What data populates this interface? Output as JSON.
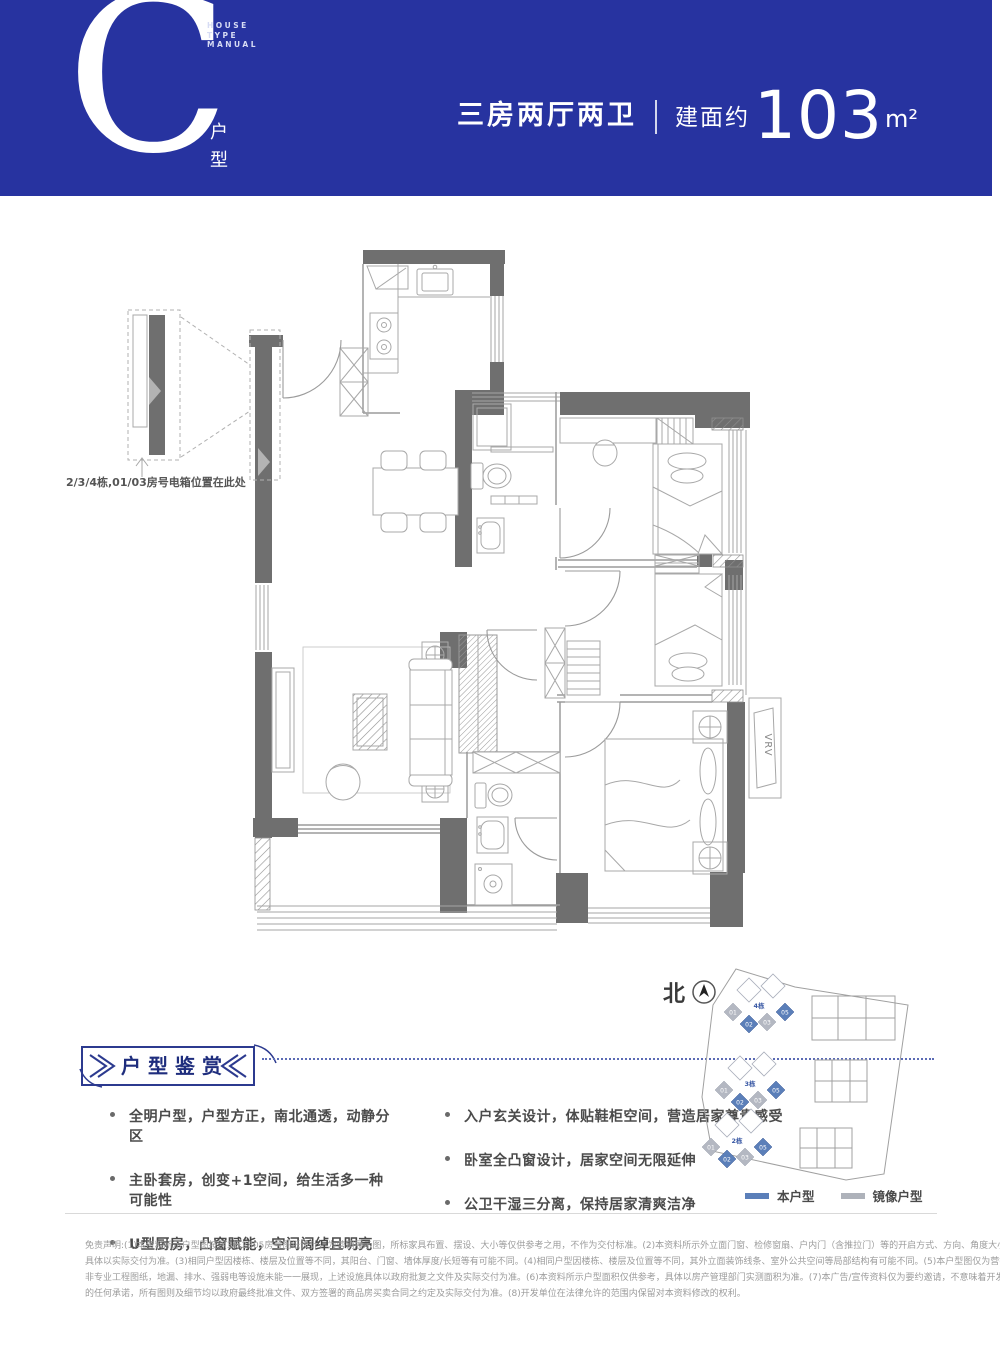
{
  "banner": {
    "letter": "C",
    "manual_text": "HOUSE\nTYPE\nMANUAL",
    "type_label": "户型",
    "spec": "三房两厅两卫",
    "area_prefix": "建面约",
    "area_number": "103",
    "area_unit": "m²",
    "bg_color": "#2733a0"
  },
  "floor_plan": {
    "callout_label": "2/3/4栋,01/03房号电箱位置在此处",
    "vrv_label": "VRV",
    "wall_color": "#6f6f6f"
  },
  "appreciation": {
    "title": "户型鉴赏",
    "left_items": [
      "全明户型，户型方正，南北通透，动静分区",
      "主卧套房，创变+1空间，给生活多一种可能性",
      "U型厨房，凸窗赋能，空间阔绰且明亮"
    ],
    "right_items": [
      "入户玄关设计，体贴鞋柜空间，营造居家尊贵感受",
      "卧室全凸窗设计，居家空间无限延伸",
      "公卫干湿三分离，保持居家清爽洁净"
    ],
    "accent_color": "#2c3a8f"
  },
  "site_plan": {
    "north_label": "北",
    "clusters": [
      {
        "name": "4栋",
        "units": [
          {
            "label": "01",
            "type": "mirror"
          },
          {
            "label": "02",
            "type": "self"
          },
          {
            "label": "03",
            "type": "mirror"
          },
          {
            "label": "05",
            "type": "self"
          }
        ]
      },
      {
        "name": "3栋",
        "units": [
          {
            "label": "01",
            "type": "mirror"
          },
          {
            "label": "02",
            "type": "self"
          },
          {
            "label": "03",
            "type": "mirror"
          },
          {
            "label": "05",
            "type": "self"
          }
        ]
      },
      {
        "name": "2栋",
        "units": [
          {
            "label": "01",
            "type": "mirror"
          },
          {
            "label": "02",
            "type": "self"
          },
          {
            "label": "03",
            "type": "mirror"
          },
          {
            "label": "05",
            "type": "self"
          }
        ]
      }
    ],
    "legend": [
      {
        "label": "本户型",
        "color": "#5b7fb9"
      },
      {
        "label": "镜像户型",
        "color": "#aeb2ba"
      }
    ]
  },
  "disclaimer": {
    "lines": [
      "免责声明:(1)本资料所示户型图按照3栋2805房号图纸设计，为营销展示图，所标家具布置、摆设、大小等仅供参考之用，不作为交付标准。(2)本资料所示外立面门窗、检修窗扇、户内门（含推拉门）等的开启方式、方向、角度大小仅为示意，",
      "具体以实际交付为准。(3)相同户型因楼栋、楼层及位置等不同，其阳台、门窗、墙体厚度/长短等有可能不同。(4)相同户型因楼栋、楼层及位置等不同，其外立面装饰线条、室外公共空间等局部结构有可能不同。(5)本户型图仅为营销宣传，",
      "非专业工程图纸，地漏、排水、强弱电等设施未能一一展现，上述设施具体以政府批复之文件及实际交付为准。(6)本资料所示户型面积仅供参考，具体以房产管理部门实测面积为准。(7)本广告/宣传资料仅为要约邀请，不意味着开发单位",
      "的任何承诺，所有图则及细节均以政府最终批准文件、双方签署的商品房买卖合同之约定及实际交付为准。(8)开发单位在法律允许的范围内保留对本资料修改的权利。"
    ]
  }
}
